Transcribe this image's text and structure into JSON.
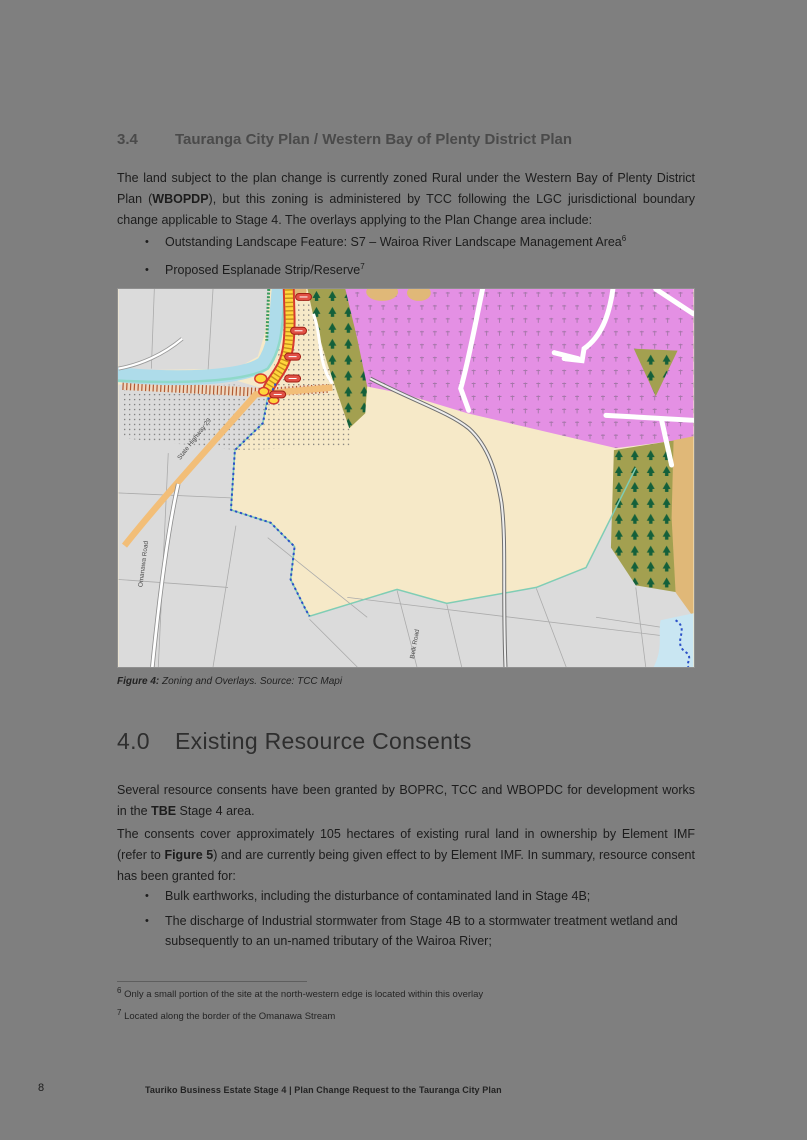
{
  "page": {
    "background": "#7f7f7f",
    "number": "8",
    "footer_text": "Tauriko Business Estate Stage 4 | Plan Change Request to the Tauranga City Plan"
  },
  "section_34": {
    "number": "3.4",
    "title": "Tauranga City Plan / Western Bay of Plenty District Plan",
    "para_a": "The land subject to the plan change is currently zoned Rural under the Western Bay of Plenty District Plan (",
    "para_bold": "WBOPDP",
    "para_b": "), but this zoning is administered by TCC following the LGC jurisdictional boundary change applicable to Stage 4. The overlays applying to the Plan Change area include:",
    "bullet_marker": "•",
    "bullets": [
      {
        "text": "Outstanding Landscape Feature: S7 – Wairoa River Landscape Management Area",
        "sup": "6"
      },
      {
        "text": "Proposed Esplanade Strip/Reserve",
        "sup": "7"
      }
    ]
  },
  "figure": {
    "caption_label": "Figure 4:",
    "caption_text": " Zoning and Overlays. Source: TCC Mapi",
    "map_labels": {
      "highway": "State Highway 29",
      "road_left": "Omanawa Road",
      "road_right": "Belk Road"
    },
    "legend_colors": {
      "rural_zone": "#f6e9c8",
      "future_urban_zone": "#e490e4",
      "conservation_forest": "#a3a050",
      "urban_parcels": "#dbdbdb",
      "river": "#aedcea",
      "state_highway": "#f2be78",
      "designation_strip": "#ffd63c",
      "designation_outline": "#d63a2f",
      "boundary_dashed": "#2b50c8",
      "site_edge_teal": "#7fcdb5"
    }
  },
  "section_40": {
    "number": "4.0",
    "title": "Existing Resource Consents",
    "para1_a": "Several resource consents have been granted by BOPRC, TCC and WBOPDC for development works in the ",
    "para1_bold": "TBE",
    "para1_b": " Stage 4 area.",
    "para2_a": "The consents cover approximately 105 hectares of existing rural land in ownership by Element IMF (refer to ",
    "para2_bold": "Figure 5",
    "para2_b": ") and are currently being given effect to by Element IMF. In summary, resource consent has been granted for:",
    "bullet_marker": "•",
    "bullets": [
      "Bulk earthworks, including the disturbance of contaminated land in Stage 4B;",
      "The discharge of Industrial stormwater from Stage 4B to a stormwater treatment wetland and subsequently to an un-named tributary of the Wairoa River;"
    ]
  },
  "footnotes": [
    {
      "sup": "6",
      "text": "Only a small portion of the site at the north-western edge is located within this overlay"
    },
    {
      "sup": "7",
      "text": "Located along the border of the Omanawa Stream"
    }
  ]
}
